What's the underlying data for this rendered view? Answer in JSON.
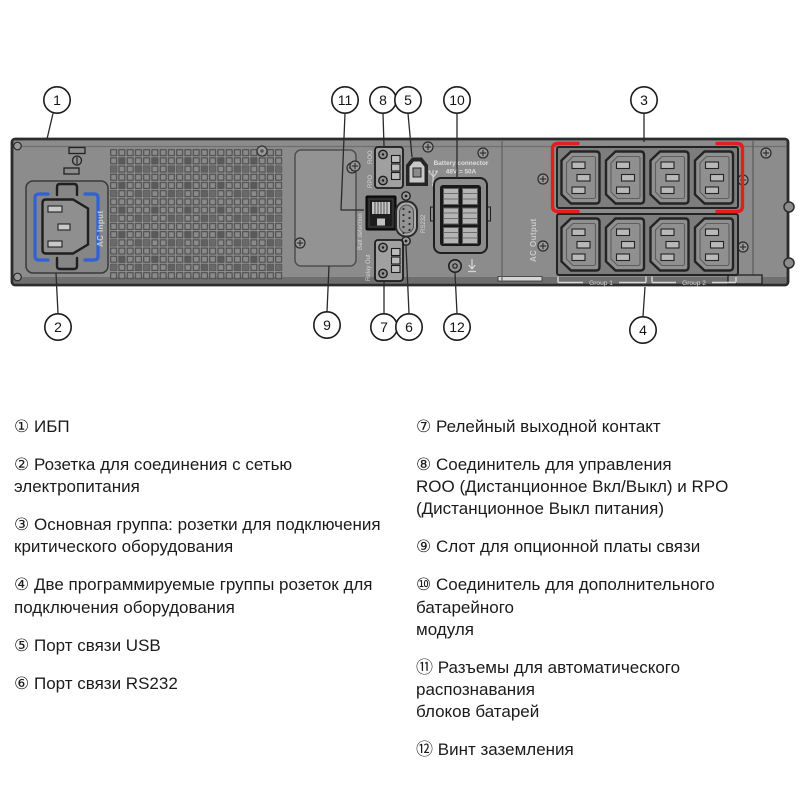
{
  "colors": {
    "panel": "#8c8c8c",
    "panel_dark": "#2d2d2d",
    "accent_red": "#e02020",
    "accent_blue": "#2f62d8",
    "label_text": "#d0d0d0"
  },
  "diagram": {
    "callouts": {
      "c1": "1",
      "c2": "2",
      "c3": "3",
      "c4": "4",
      "c5": "5",
      "c6": "6",
      "c7": "7",
      "c8": "8",
      "c9": "9",
      "c10": "10",
      "c11": "11",
      "c12": "12"
    },
    "labels": {
      "ac_input": "AC Input",
      "roo": "ROO",
      "rpo": "RPO",
      "batt_detection": "Batt detection",
      "rs232": "RS232",
      "relay_out": "Relay Out",
      "battery_connector": "Battery connector",
      "battery_rating": "48V = 50A",
      "ac_output": "AC Output",
      "group_1": "Group 1",
      "group_2": "Group 2"
    }
  },
  "legend": {
    "left": [
      {
        "num": "①",
        "text": "ИБП"
      },
      {
        "num": "②",
        "text": "Розетка для соединения с сетью\nэлектропитания"
      },
      {
        "num": "③",
        "text": "Основная группа: розетки для подключения\nкритического оборудования"
      },
      {
        "num": "④",
        "text": "Две программируемые группы розеток для\nподключения оборудования"
      },
      {
        "num": "⑤",
        "text": "Порт связи USB"
      },
      {
        "num": "⑥",
        "text": "Порт связи RS232"
      }
    ],
    "right": [
      {
        "num": "⑦",
        "text": "Релейный выходной контакт"
      },
      {
        "num": "⑧",
        "text": "Соединитель для управления\nROO (Дистанционное Вкл/Выкл) и RPO\n(Дистанционное Выкл питания)"
      },
      {
        "num": "⑨",
        "text": "Слот для опционной платы связи"
      },
      {
        "num": "⑩",
        "text": "Соединитель для дополнительного батарейного\nмодуля"
      },
      {
        "num": "⑪",
        "text": "Разъемы для автоматического распознавания\nблоков батарей"
      },
      {
        "num": "⑫",
        "text": "Винт заземления"
      }
    ]
  }
}
